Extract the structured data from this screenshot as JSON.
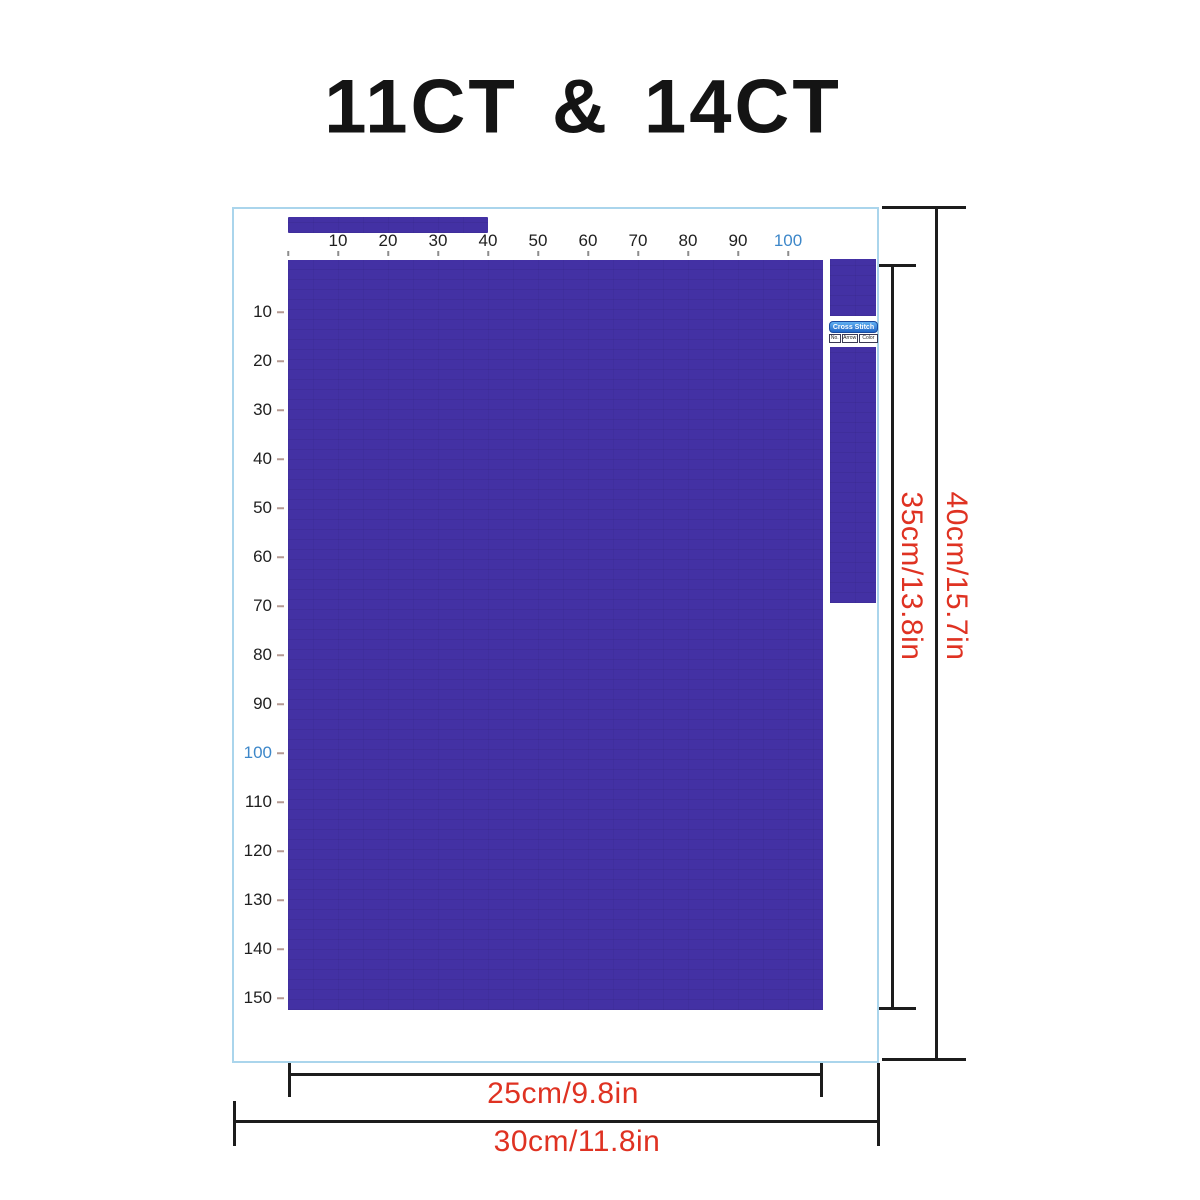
{
  "title": "11CT & 14CT",
  "h_ruler_labels": [
    "10",
    "20",
    "30",
    "40",
    "50",
    "60",
    "70",
    "80",
    "90",
    "100"
  ],
  "v_ruler_labels": [
    "10",
    "20",
    "30",
    "40",
    "50",
    "60",
    "70",
    "80",
    "90",
    "100",
    "110",
    "120",
    "130",
    "140",
    "150"
  ],
  "highlight_label": "100",
  "legend": {
    "header": "Cross Stitch",
    "cols": [
      "No.",
      "Arrow",
      "Color"
    ]
  },
  "dims": {
    "inner_width": "25cm/9.8in",
    "outer_width": "30cm/11.8in",
    "inner_height": "35cm/13.8in",
    "outer_height": "40cm/15.7in"
  },
  "colors": {
    "fabric": "#4331a4",
    "frame": "#aad5ec",
    "accent_blue": "#3d87c9",
    "dim_red": "#df3222"
  }
}
